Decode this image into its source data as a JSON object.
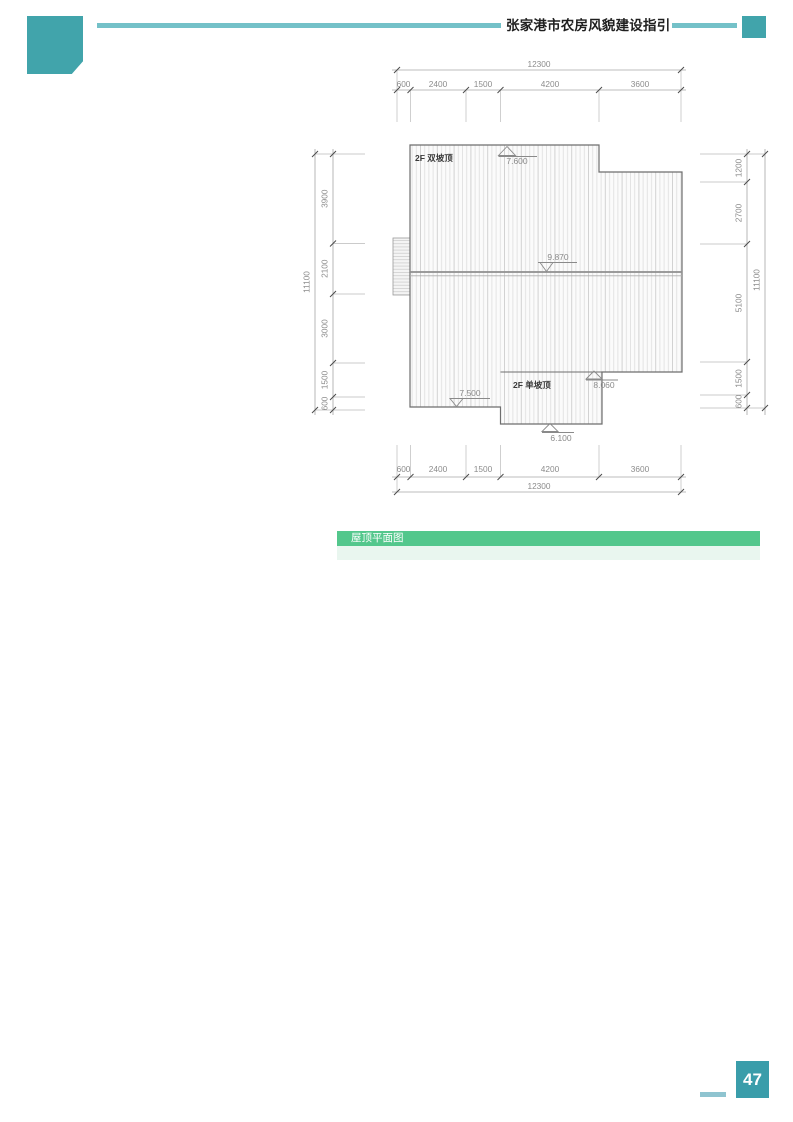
{
  "header": {
    "title": "张家港市农房风貌建设指引"
  },
  "figure": {
    "roof_labels": {
      "double_slope": "2F 双坡顶",
      "single_slope": "2F 单坡顶"
    },
    "elevations": {
      "upper_ridge": "7.600",
      "main_ridge": "9.870",
      "left_eave": "7.500",
      "porch_top": "8.060",
      "porch_eave": "6.100"
    },
    "dimensions": {
      "top": {
        "segments": [
          "600",
          "2400",
          "1500",
          "4200",
          "3600"
        ],
        "total": "12300"
      },
      "bottom": {
        "segments": [
          "600",
          "2400",
          "1500",
          "4200",
          "3600"
        ],
        "total": "12300"
      },
      "left": {
        "segments": [
          "3900",
          "2100",
          "3000",
          "1500",
          "600"
        ],
        "total": "11100"
      },
      "right": {
        "segments": [
          "1200",
          "2700",
          "5100",
          "1500",
          "600"
        ],
        "total": "11100"
      }
    }
  },
  "caption": {
    "label": "屋顶平面图"
  },
  "footer": {
    "page_number": "47"
  },
  "colors": {
    "teal": "#41a4ab",
    "teal_dark": "#3a9daa",
    "teal_light": "#74c1c8",
    "teal_pale": "#8fc4d0",
    "green": "#53c78c",
    "green_pale": "#e9f6ef"
  }
}
